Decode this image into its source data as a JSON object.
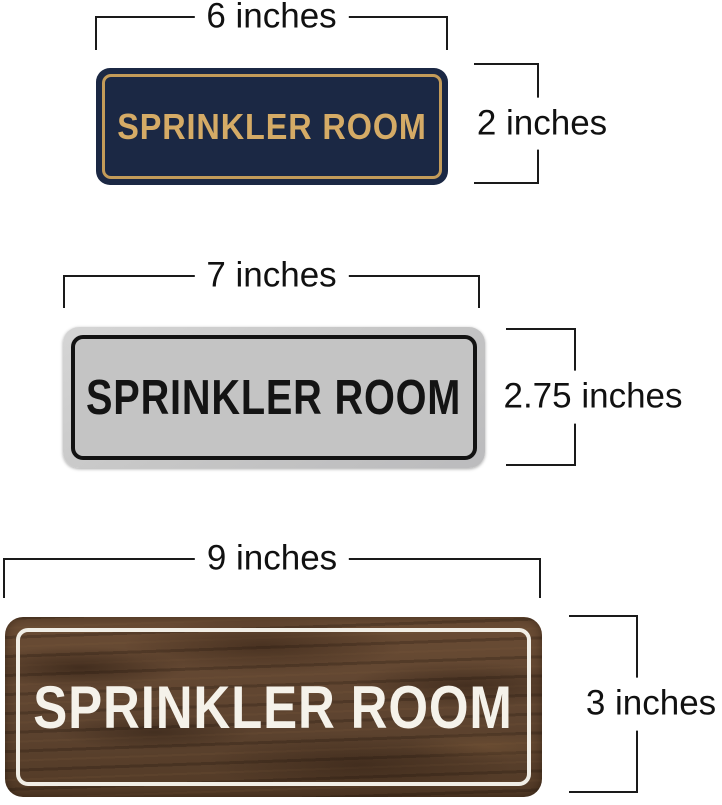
{
  "signs": [
    {
      "style": "navy-gold",
      "text": "SPRINKLER ROOM",
      "width_label": "6 inches",
      "height_label": "2 inches",
      "colors": {
        "background": "#1b2844",
        "border": "#c39b59",
        "text": "#d5ab66"
      }
    },
    {
      "style": "silver-black",
      "text": "SPRINKLER ROOM",
      "width_label": "7 inches",
      "height_label": "2.75 inches",
      "colors": {
        "background": "#c4c4c4",
        "frame": "#cccccc",
        "border": "#131313",
        "text": "#141414"
      }
    },
    {
      "style": "walnut-wood-white",
      "text": "SPRINKLER ROOM",
      "width_label": "9 inches",
      "height_label": "3 inches",
      "colors": {
        "background": "#5e4430",
        "border": "#f1eee6",
        "text": "#f5f2ea"
      }
    }
  ],
  "annotation": {
    "line_color": "#1a1a1a",
    "text_color": "#111111",
    "background": "#ffffff"
  }
}
